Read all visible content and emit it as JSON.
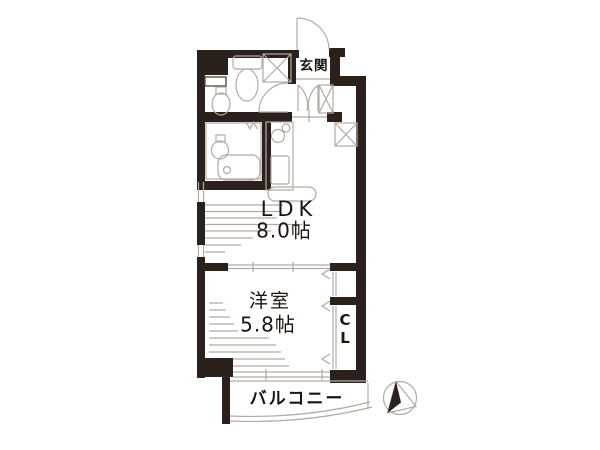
{
  "title": "apartment-floor-plan",
  "rooms": {
    "genkan": "玄関",
    "ldk_name": "LDK",
    "ldk_size": "8.0帖",
    "western_name": "洋室",
    "western_size": "5.8帖",
    "closet_c": "C",
    "closet_l": "L",
    "balcony": "バルコニー"
  },
  "colors": {
    "wall": "#2b211c",
    "line": "#b2aaa2",
    "text": "#1d140e",
    "bg": "#ffffff"
  }
}
